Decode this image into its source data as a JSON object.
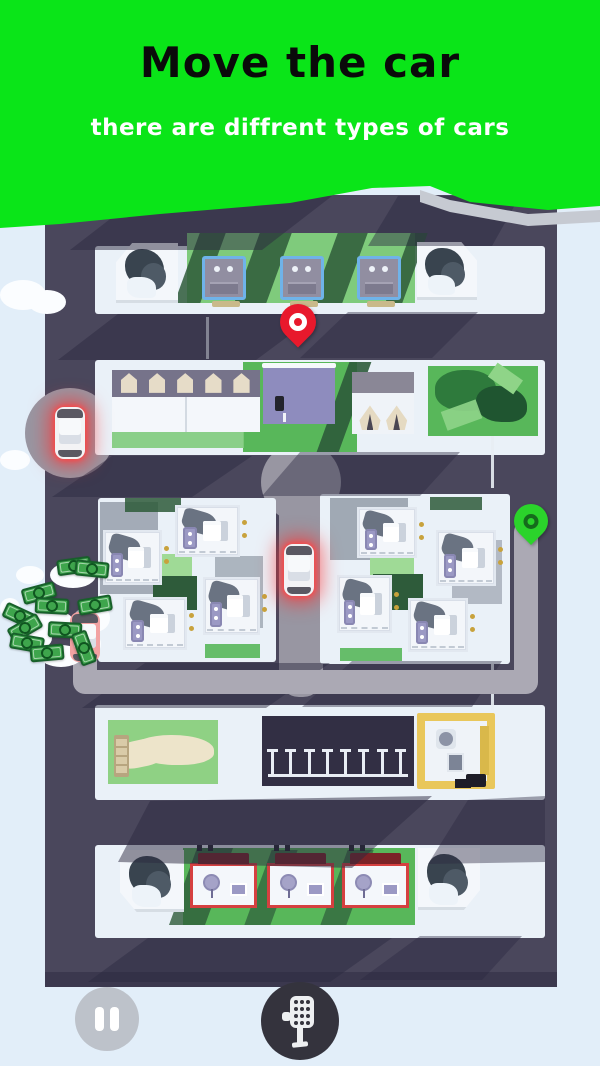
{
  "header": {
    "title": "Move the car",
    "subtitle": "there are diffrent types of cars",
    "bg_color": "#0AE518",
    "title_color": "#0A0A0A",
    "subtitle_color": "#FFFFFF",
    "torn_shadow_color": "#C6CAD2"
  },
  "page": {
    "bg_color": "#E2EEF9"
  },
  "controls": {
    "pause_icon": "pause-icon",
    "shifter_icon": "gear-shifter-icon",
    "pause_bg": "#BDC2CA",
    "shifter_bg": "#34333D"
  },
  "palette": {
    "white": "#EAF1F8",
    "white2": "#F4F7FB",
    "road": "#4A475C",
    "roadL": "#9896A2",
    "g1": "#7FCB7C",
    "g2": "#58B75A",
    "gL": "#9FDA96",
    "gD": "#2E5B3A",
    "navy": "#3A4456",
    "court": "#8E8CBE",
    "beige": "#C9B98A",
    "pkDark": "#322F44",
    "cloud": "#FBFDFF",
    "billG": "#3EA54C",
    "mapEdge": "#3B384E"
  },
  "map": {
    "shadow_color": "#2B2940",
    "route": {
      "pts": "85,620 85,682 526,682 526,532",
      "width": 24,
      "color": "#ABA9B4"
    },
    "shadows": [
      {
        "pts": "140,196 332,196 262,250 70,250",
        "o": 0.5
      },
      {
        "pts": "398,196 520,196 492,246 368,246",
        "o": 0.45
      },
      {
        "pts": "118,314 318,314 256,360 58,360",
        "o": 0.5
      },
      {
        "pts": "348,312 478,312 432,358 300,358",
        "o": 0.42
      },
      {
        "pts": "112,456 252,456 192,497 52,497",
        "o": 0.48
      },
      {
        "pts": "300,452 460,452 420,496 262,496",
        "o": 0.42
      },
      {
        "pts": "145,663 330,663 266,708 82,708",
        "o": 0.48
      },
      {
        "pts": "352,661 502,661 472,707 302,707",
        "o": 0.42
      },
      {
        "pts": "150,801 432,796 352,868 118,862",
        "o": 0.5
      },
      {
        "pts": "468,800 545,796 545,862 428,864",
        "o": 0.42
      },
      {
        "pts": "148,938 392,938 330,982 88,982",
        "o": 0.48
      },
      {
        "pts": "420,936 522,936 482,980 360,980",
        "o": 0.4
      }
    ]
  },
  "scene": [
    {
      "t": "rect",
      "n": "city-map",
      "x": 45,
      "y": 195,
      "w": 512,
      "h": 792,
      "c": "road",
      "r": "8px"
    },
    {
      "t": "rect",
      "n": "map-bottom-edge",
      "x": 45,
      "y": 972,
      "w": 512,
      "h": 15,
      "c": "mapEdge"
    },
    {
      "t": "rect",
      "n": "road-light-spot",
      "x": 25,
      "y": 388,
      "w": 90,
      "h": 90,
      "c": "roadL",
      "r": "50%"
    },
    {
      "t": "rect",
      "n": "middle-road",
      "x": 279,
      "y": 452,
      "w": 44,
      "h": 245,
      "c": "roadL",
      "r": "20px"
    },
    {
      "t": "rect",
      "n": "road-light-spot",
      "x": 261,
      "y": 442,
      "w": 80,
      "h": 80,
      "c": "roadL",
      "r": "50%"
    },
    {
      "t": "rect",
      "n": "sidewalk-row1",
      "x": 95,
      "y": 246,
      "w": 450,
      "h": 68,
      "c": "white",
      "r": "3px"
    },
    {
      "t": "rect",
      "n": "grass-row1",
      "x": 187,
      "y": 233,
      "w": 228,
      "h": 70,
      "c": "g1"
    },
    {
      "t": "rect",
      "n": "grass-shadow",
      "v": "skew",
      "x": 187,
      "y": 233,
      "w": 26,
      "h": 70,
      "c": "gD",
      "o": 0.85
    },
    {
      "t": "rect",
      "n": "grass-shadow",
      "v": "skew",
      "x": 247,
      "y": 233,
      "w": 32,
      "h": 70,
      "c": "gD",
      "o": 0.85
    },
    {
      "t": "rect",
      "n": "grass-shadow",
      "v": "skew",
      "x": 325,
      "y": 233,
      "w": 30,
      "h": 70,
      "c": "gD",
      "o": 0.85
    },
    {
      "t": "rect",
      "n": "grass-shadow",
      "v": "skew",
      "x": 398,
      "y": 233,
      "w": 17,
      "h": 70,
      "c": "gD",
      "o": 0.85
    },
    {
      "t": "corner",
      "v": "corner-tl",
      "n": "tree-block",
      "x": 116,
      "y": 243,
      "w": 62,
      "h": 60,
      "c": "white2"
    },
    {
      "t": "garage",
      "n": "garage-building",
      "x": 202,
      "y": 256,
      "w": 44,
      "h": 44
    },
    {
      "t": "garage",
      "n": "garage-building",
      "x": 280,
      "y": 256,
      "w": 44,
      "h": 44
    },
    {
      "t": "garage",
      "n": "garage-building",
      "x": 357,
      "y": 256,
      "w": 44,
      "h": 44
    },
    {
      "t": "rect",
      "n": "bench",
      "x": 212,
      "y": 301,
      "w": 28,
      "h": 6,
      "c": "beige",
      "r": "2px"
    },
    {
      "t": "rect",
      "n": "bench",
      "x": 290,
      "y": 301,
      "w": 28,
      "h": 6,
      "c": "beige",
      "r": "2px"
    },
    {
      "t": "rect",
      "n": "bench",
      "x": 367,
      "y": 301,
      "w": 28,
      "h": 6,
      "c": "beige",
      "r": "2px"
    },
    {
      "t": "corner",
      "v": "corner-tr",
      "n": "tree-block",
      "x": 417,
      "y": 242,
      "w": 60,
      "h": 58,
      "c": "white2"
    },
    {
      "t": "rect",
      "n": "lane-mark",
      "x": 206,
      "y": 317,
      "w": 3,
      "h": 42,
      "c": "#E8EDF3",
      "o": 0.9
    },
    {
      "t": "rect",
      "n": "sidewalk-row2",
      "x": 95,
      "y": 360,
      "w": 450,
      "h": 95,
      "c": "white",
      "r": "3px"
    },
    {
      "t": "rect",
      "n": "grass-row2",
      "x": 243,
      "y": 362,
      "w": 114,
      "h": 90,
      "c": "g2"
    },
    {
      "t": "rect",
      "n": "grass-shadow",
      "v": "skew",
      "x": 333,
      "y": 362,
      "w": 22,
      "h": 90,
      "c": "gD",
      "o": 0.9
    },
    {
      "t": "rect",
      "n": "grass-row2",
      "x": 112,
      "y": 432,
      "w": 132,
      "h": 16,
      "c": "g1",
      "o": 0.9
    },
    {
      "t": "storage",
      "n": "storage-building",
      "x": 112,
      "y": 370,
      "w": 148,
      "h": 62
    },
    {
      "t": "court",
      "n": "sports-court",
      "x": 263,
      "y": 366,
      "w": 72,
      "h": 58,
      "c": "court"
    },
    {
      "t": "tents",
      "n": "tents-building",
      "x": 352,
      "y": 372,
      "w": 62,
      "h": 62
    },
    {
      "t": "parkdense",
      "n": "park-dense",
      "x": 428,
      "y": 366,
      "w": 110,
      "h": 70,
      "c": "g2"
    },
    {
      "t": "rect",
      "n": "housing-block-left",
      "x": 98,
      "y": 498,
      "w": 178,
      "h": 164,
      "c": "white",
      "r": "3px"
    },
    {
      "t": "rect",
      "n": "housing-block-right",
      "x": 320,
      "y": 494,
      "w": 190,
      "h": 170,
      "c": "white",
      "r": "3px"
    },
    {
      "t": "rect",
      "n": "block-shadow",
      "x": 100,
      "y": 502,
      "w": 58,
      "h": 92,
      "c": "navy",
      "o": 0.4
    },
    {
      "t": "rect",
      "n": "block-shadow",
      "x": 215,
      "y": 556,
      "w": 48,
      "h": 72,
      "c": "navy",
      "o": 0.35
    },
    {
      "t": "rect",
      "n": "grass-patch",
      "x": 150,
      "y": 554,
      "w": 42,
      "h": 26,
      "c": "gL"
    },
    {
      "t": "rect",
      "n": "grass-patch",
      "x": 153,
      "y": 576,
      "w": 44,
      "h": 34,
      "c": "gD"
    },
    {
      "t": "rect",
      "n": "grass-patch",
      "x": 125,
      "y": 498,
      "w": 56,
      "h": 14,
      "c": "gD",
      "o": 0.85
    },
    {
      "t": "rect",
      "n": "grass-patch",
      "x": 205,
      "y": 644,
      "w": 55,
      "h": 14,
      "c": "g2",
      "o": 0.9
    },
    {
      "t": "rect",
      "n": "block-shadow",
      "x": 330,
      "y": 498,
      "w": 78,
      "h": 62,
      "c": "navy",
      "o": 0.42
    },
    {
      "t": "rect",
      "n": "block-shadow",
      "x": 452,
      "y": 540,
      "w": 50,
      "h": 64,
      "c": "navy",
      "o": 0.32
    },
    {
      "t": "rect",
      "n": "grass-patch",
      "x": 370,
      "y": 556,
      "w": 44,
      "h": 20,
      "c": "gL"
    },
    {
      "t": "rect",
      "n": "grass-patch",
      "x": 373,
      "y": 574,
      "w": 50,
      "h": 36,
      "c": "gD"
    },
    {
      "t": "rect",
      "n": "grass-patch",
      "x": 430,
      "y": 497,
      "w": 52,
      "h": 13,
      "c": "gD",
      "o": 0.85
    },
    {
      "t": "rect",
      "n": "grass-patch",
      "x": 340,
      "y": 648,
      "w": 62,
      "h": 13,
      "c": "g2",
      "o": 0.9
    },
    {
      "t": "house",
      "n": "house",
      "x": 103,
      "y": 530,
      "w": 59,
      "h": 55
    },
    {
      "t": "house",
      "n": "house",
      "x": 175,
      "y": 505,
      "w": 65,
      "h": 52
    },
    {
      "t": "house",
      "n": "house",
      "x": 123,
      "y": 597,
      "w": 64,
      "h": 53
    },
    {
      "t": "house",
      "n": "house",
      "x": 203,
      "y": 577,
      "w": 57,
      "h": 58
    },
    {
      "t": "house",
      "n": "house",
      "x": 357,
      "y": 507,
      "w": 60,
      "h": 51
    },
    {
      "t": "house",
      "n": "house",
      "x": 436,
      "y": 530,
      "w": 60,
      "h": 56
    },
    {
      "t": "house",
      "n": "house",
      "x": 337,
      "y": 575,
      "w": 55,
      "h": 58
    },
    {
      "t": "house",
      "n": "house",
      "x": 408,
      "y": 598,
      "w": 60,
      "h": 54
    },
    {
      "t": "rect",
      "n": "sidewalk-row4",
      "x": 95,
      "y": 705,
      "w": 450,
      "h": 95,
      "c": "white",
      "r": "3px"
    },
    {
      "t": "parkpath",
      "n": "park-with-path",
      "x": 108,
      "y": 720,
      "w": 110,
      "h": 64
    },
    {
      "t": "parking",
      "n": "parking-lot",
      "x": 262,
      "y": 716,
      "w": 152,
      "h": 70,
      "c": "pkDark",
      "nn": 8
    },
    {
      "t": "gas",
      "n": "gas-station",
      "x": 417,
      "y": 713,
      "w": 78,
      "h": 76
    },
    {
      "t": "rect",
      "n": "sidewalk-row5",
      "x": 95,
      "y": 845,
      "w": 450,
      "h": 93,
      "c": "white",
      "r": "3px"
    },
    {
      "t": "rect",
      "n": "grass-row5",
      "x": 183,
      "y": 848,
      "w": 232,
      "h": 77,
      "c": "g2"
    },
    {
      "t": "rect",
      "n": "grass-shadow",
      "v": "skew",
      "x": 183,
      "y": 848,
      "w": 36,
      "h": 77,
      "c": "gD",
      "o": 0.8
    },
    {
      "t": "rect",
      "n": "grass-shadow",
      "v": "skew",
      "x": 258,
      "y": 850,
      "w": 26,
      "h": 75,
      "c": "gD",
      "o": 0.7
    },
    {
      "t": "rect",
      "n": "grass-shadow",
      "v": "skew",
      "x": 334,
      "y": 850,
      "w": 26,
      "h": 75,
      "c": "gD",
      "o": 0.7
    },
    {
      "t": "corner",
      "v": "corner-bl",
      "n": "tree-block",
      "x": 120,
      "y": 850,
      "w": 64,
      "h": 62,
      "c": "white2"
    },
    {
      "t": "redhouse",
      "n": "red-house",
      "x": 190,
      "y": 863,
      "w": 67,
      "h": 45
    },
    {
      "t": "redhouse",
      "n": "red-house",
      "x": 267,
      "y": 863,
      "w": 67,
      "h": 45
    },
    {
      "t": "redhouse",
      "n": "red-house",
      "x": 342,
      "y": 863,
      "w": 67,
      "h": 45
    },
    {
      "t": "corner",
      "v": "corner-br",
      "n": "tree-block",
      "x": 418,
      "y": 848,
      "w": 62,
      "h": 62,
      "c": "white2"
    },
    {
      "t": "rect",
      "n": "lane-mark",
      "x": 491,
      "y": 436,
      "w": 3,
      "h": 52,
      "c": "#E8EDF3",
      "o": 0.9
    },
    {
      "t": "rect",
      "n": "lane-mark",
      "x": 491,
      "y": 664,
      "w": 3,
      "h": 46,
      "c": "#E8EDF3",
      "o": 0.9
    },
    {
      "t": "shadows",
      "n": "building-shadows",
      "x": 0,
      "y": 0,
      "w": 600,
      "h": 1066
    },
    {
      "t": "route",
      "n": "route-path",
      "x": 0,
      "y": 0,
      "w": 600,
      "h": 1066
    },
    {
      "t": "rect",
      "n": "cloud",
      "x": 0,
      "y": 280,
      "w": 46,
      "h": 30,
      "c": "cloud",
      "r": "50%"
    },
    {
      "t": "rect",
      "n": "cloud",
      "x": 28,
      "y": 290,
      "w": 38,
      "h": 24,
      "c": "cloud",
      "r": "50%"
    },
    {
      "t": "rect",
      "n": "cloud",
      "x": 0,
      "y": 450,
      "w": 30,
      "h": 20,
      "c": "cloud",
      "r": "50%"
    },
    {
      "t": "rect",
      "n": "cloud",
      "x": 16,
      "y": 566,
      "w": 28,
      "h": 18,
      "c": "cloud",
      "r": "50%"
    },
    {
      "t": "rect",
      "n": "cloud",
      "x": 50,
      "y": 562,
      "w": 46,
      "h": 26,
      "c": "cloud",
      "r": "50%"
    },
    {
      "t": "rect",
      "n": "cloud",
      "x": 0,
      "y": 598,
      "w": 20,
      "h": 20,
      "c": "cloud",
      "r": "50%"
    },
    {
      "t": "rect",
      "n": "cloud",
      "x": 30,
      "y": 610,
      "w": 44,
      "h": 26,
      "c": "cloud",
      "r": "50%"
    },
    {
      "t": "rect",
      "n": "cloud",
      "x": 80,
      "y": 604,
      "w": 30,
      "h": 28,
      "c": "cloud",
      "r": "50%"
    },
    {
      "t": "rect",
      "n": "cloud",
      "x": 16,
      "y": 626,
      "w": 36,
      "h": 24,
      "c": "cloud",
      "r": "50%"
    },
    {
      "t": "rect",
      "n": "cloud",
      "x": 40,
      "y": 645,
      "w": 42,
      "h": 22,
      "c": "cloud",
      "r": "50%"
    },
    {
      "t": "rect",
      "n": "cloud",
      "x": 76,
      "y": 632,
      "w": 25,
      "h": 24,
      "c": "cloud",
      "r": "50%"
    },
    {
      "t": "car",
      "n": "pink-car",
      "i": true,
      "x": 70,
      "y": 612,
      "w": 30,
      "h": 50,
      "c": "#F2A2A2"
    },
    {
      "t": "bill",
      "n": "money-bill",
      "x": 57,
      "y": 558,
      "w": 34,
      "h": 16,
      "c": "billG",
      "rot": -8
    },
    {
      "t": "bill",
      "n": "money-bill",
      "x": 75,
      "y": 561,
      "w": 34,
      "h": 16,
      "c": "billG",
      "rot": 6
    },
    {
      "t": "bill",
      "n": "money-bill",
      "x": 22,
      "y": 585,
      "w": 34,
      "h": 16,
      "c": "billG",
      "rot": -15
    },
    {
      "t": "bill",
      "n": "money-bill",
      "x": 35,
      "y": 598,
      "w": 34,
      "h": 16,
      "c": "billG",
      "rot": 3
    },
    {
      "t": "bill",
      "n": "money-bill",
      "x": 78,
      "y": 597,
      "w": 34,
      "h": 16,
      "c": "billG",
      "rot": -10
    },
    {
      "t": "bill",
      "n": "money-bill",
      "x": 3,
      "y": 608,
      "w": 34,
      "h": 16,
      "c": "billG",
      "rot": 25
    },
    {
      "t": "bill",
      "n": "money-bill",
      "x": 8,
      "y": 620,
      "w": 34,
      "h": 16,
      "c": "billG",
      "rot": -30
    },
    {
      "t": "bill",
      "n": "money-bill",
      "x": 48,
      "y": 622,
      "w": 34,
      "h": 16,
      "c": "billG",
      "rot": 3
    },
    {
      "t": "bill",
      "n": "money-bill",
      "x": 10,
      "y": 635,
      "w": 34,
      "h": 16,
      "c": "billG",
      "rot": 10
    },
    {
      "t": "bill",
      "n": "money-bill",
      "x": 67,
      "y": 640,
      "w": 34,
      "h": 16,
      "c": "billG",
      "rot": 70
    },
    {
      "t": "bill",
      "n": "money-bill",
      "x": 30,
      "y": 645,
      "w": 34,
      "h": 16,
      "c": "billG",
      "rot": -5
    },
    {
      "t": "car",
      "n": "red-car-left",
      "i": true,
      "glow": true,
      "x": 55,
      "y": 407,
      "w": 30,
      "h": 52,
      "c": "#F3F3F5"
    },
    {
      "t": "car",
      "n": "red-car-middle",
      "i": true,
      "glow": true,
      "x": 284,
      "y": 544,
      "w": 30,
      "h": 52,
      "c": "#F3F3F5"
    },
    {
      "t": "pin",
      "v": "pin-dest",
      "n": "destination-pin",
      "x": 280,
      "y": 304,
      "w": 36,
      "h": 50
    },
    {
      "t": "pin",
      "v": "pin-start",
      "n": "start-pin",
      "x": 514,
      "y": 504,
      "w": 34,
      "h": 46
    }
  ]
}
